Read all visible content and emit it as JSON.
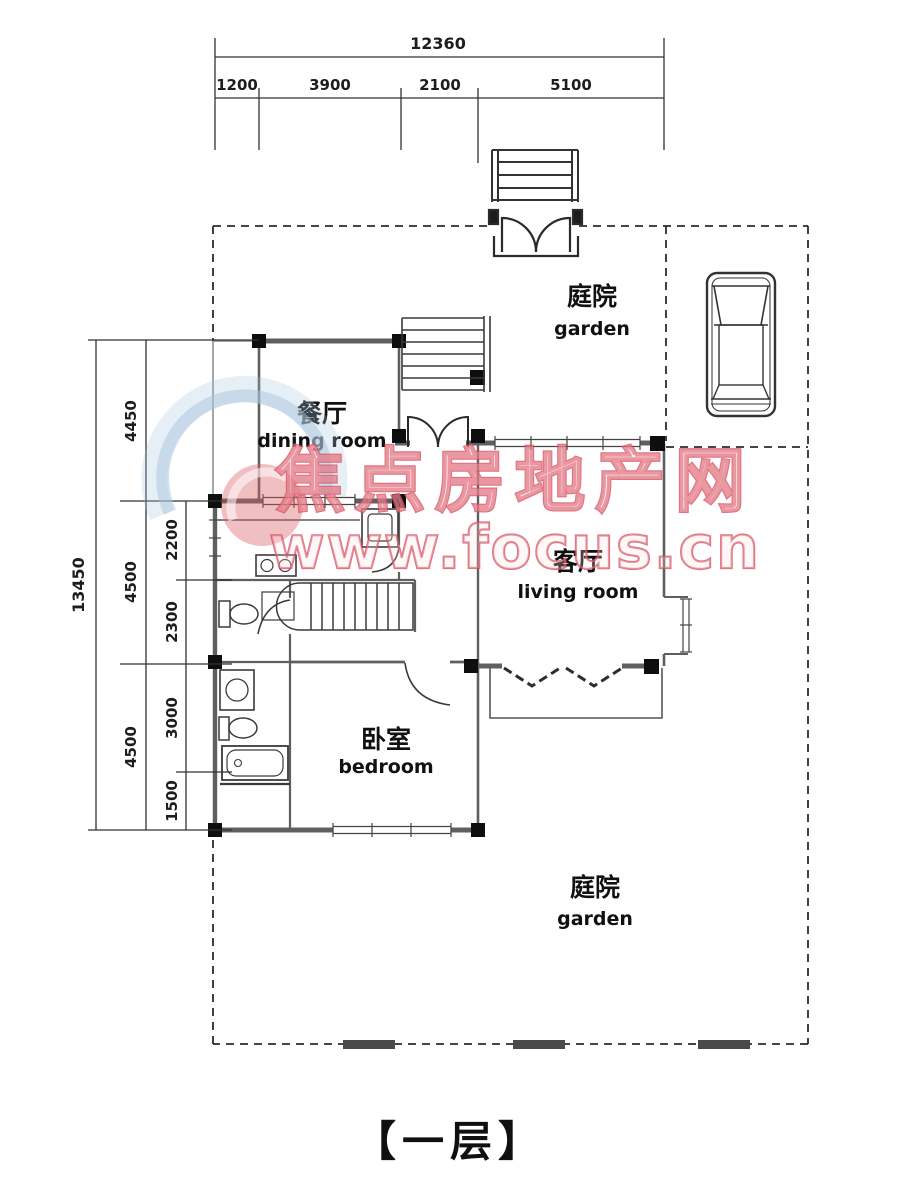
{
  "floor_title": "【一层】",
  "dimensions": {
    "top": {
      "total": "12360",
      "segments": [
        "1200",
        "3900",
        "2100",
        "5100"
      ]
    },
    "left": {
      "total": "13450",
      "mid_segments": [
        "4450",
        "4500",
        "4500"
      ],
      "inner_segments": [
        "2200",
        "2300",
        "3000",
        "1500"
      ]
    }
  },
  "rooms": {
    "garden_top": {
      "zh": "庭院",
      "en": "garden"
    },
    "dining": {
      "zh": "餐厅",
      "en": "dining room"
    },
    "living": {
      "zh": "客厅",
      "en": "living room"
    },
    "bedroom": {
      "zh": "卧室",
      "en": "bedroom"
    },
    "garden_bottom": {
      "zh": "庭院",
      "en": "garden"
    }
  },
  "watermark": {
    "line1": "焦点房地产网",
    "line2": "www.focus.cn",
    "text_color": "#d84f5f",
    "logo_blue": "#aac6dd",
    "logo_red": "#d96066"
  },
  "colors": {
    "wall": "#5f5f5f",
    "thin_line": "#444444",
    "column": "#0e0e0e",
    "dashed_boundary": "#2b2b2b",
    "hedge": "#4a4a4a"
  }
}
